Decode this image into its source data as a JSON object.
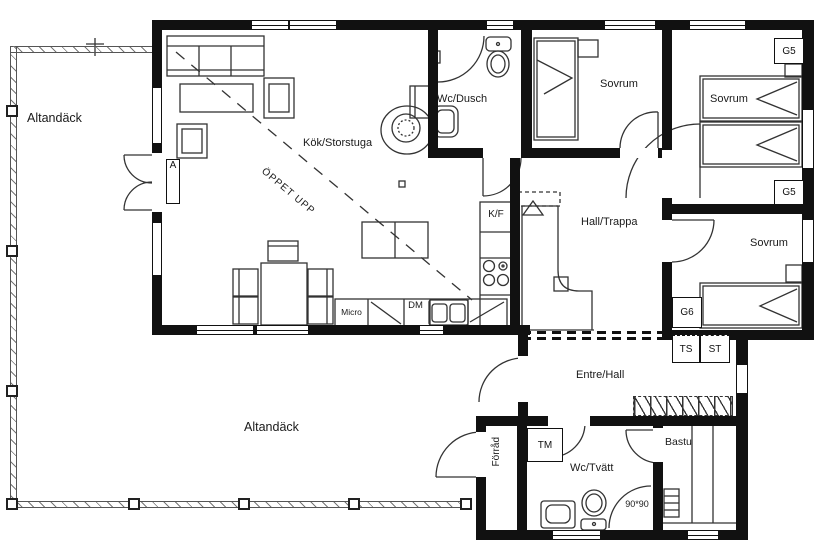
{
  "rooms": {
    "deck_left": "Altandäck",
    "deck_bottom": "Altandäck",
    "kitchen_great_room": "Kök/Storstuga",
    "wc_shower": "Wc/Dusch",
    "bedroom_top": "Sovrum",
    "bedroom_top_right": "Sovrum",
    "bedroom_right": "Sovrum",
    "hall_stairs": "Hall/Trappa",
    "entry_hall": "Entre/Hall",
    "storage": "Förråd",
    "wc_laundry": "Wc/Tvätt",
    "sauna": "Bastu"
  },
  "annotations": {
    "open_above": "ÖPPET UPP",
    "shower_size": "90*90",
    "section_marker": "A"
  },
  "appliances": {
    "fridge_freezer": "K/F",
    "dishwasher": "DM",
    "microwave": "Micro",
    "washer": "TM",
    "drying_cabinet": "TS",
    "cleaning_closet": "ST"
  },
  "wardrobes": {
    "g5_top": "G5",
    "g5_middle": "G5",
    "g6": "G6"
  },
  "colors": {
    "wall": "#111111",
    "line": "#333333",
    "background": "#ffffff",
    "railing": "#555555"
  }
}
